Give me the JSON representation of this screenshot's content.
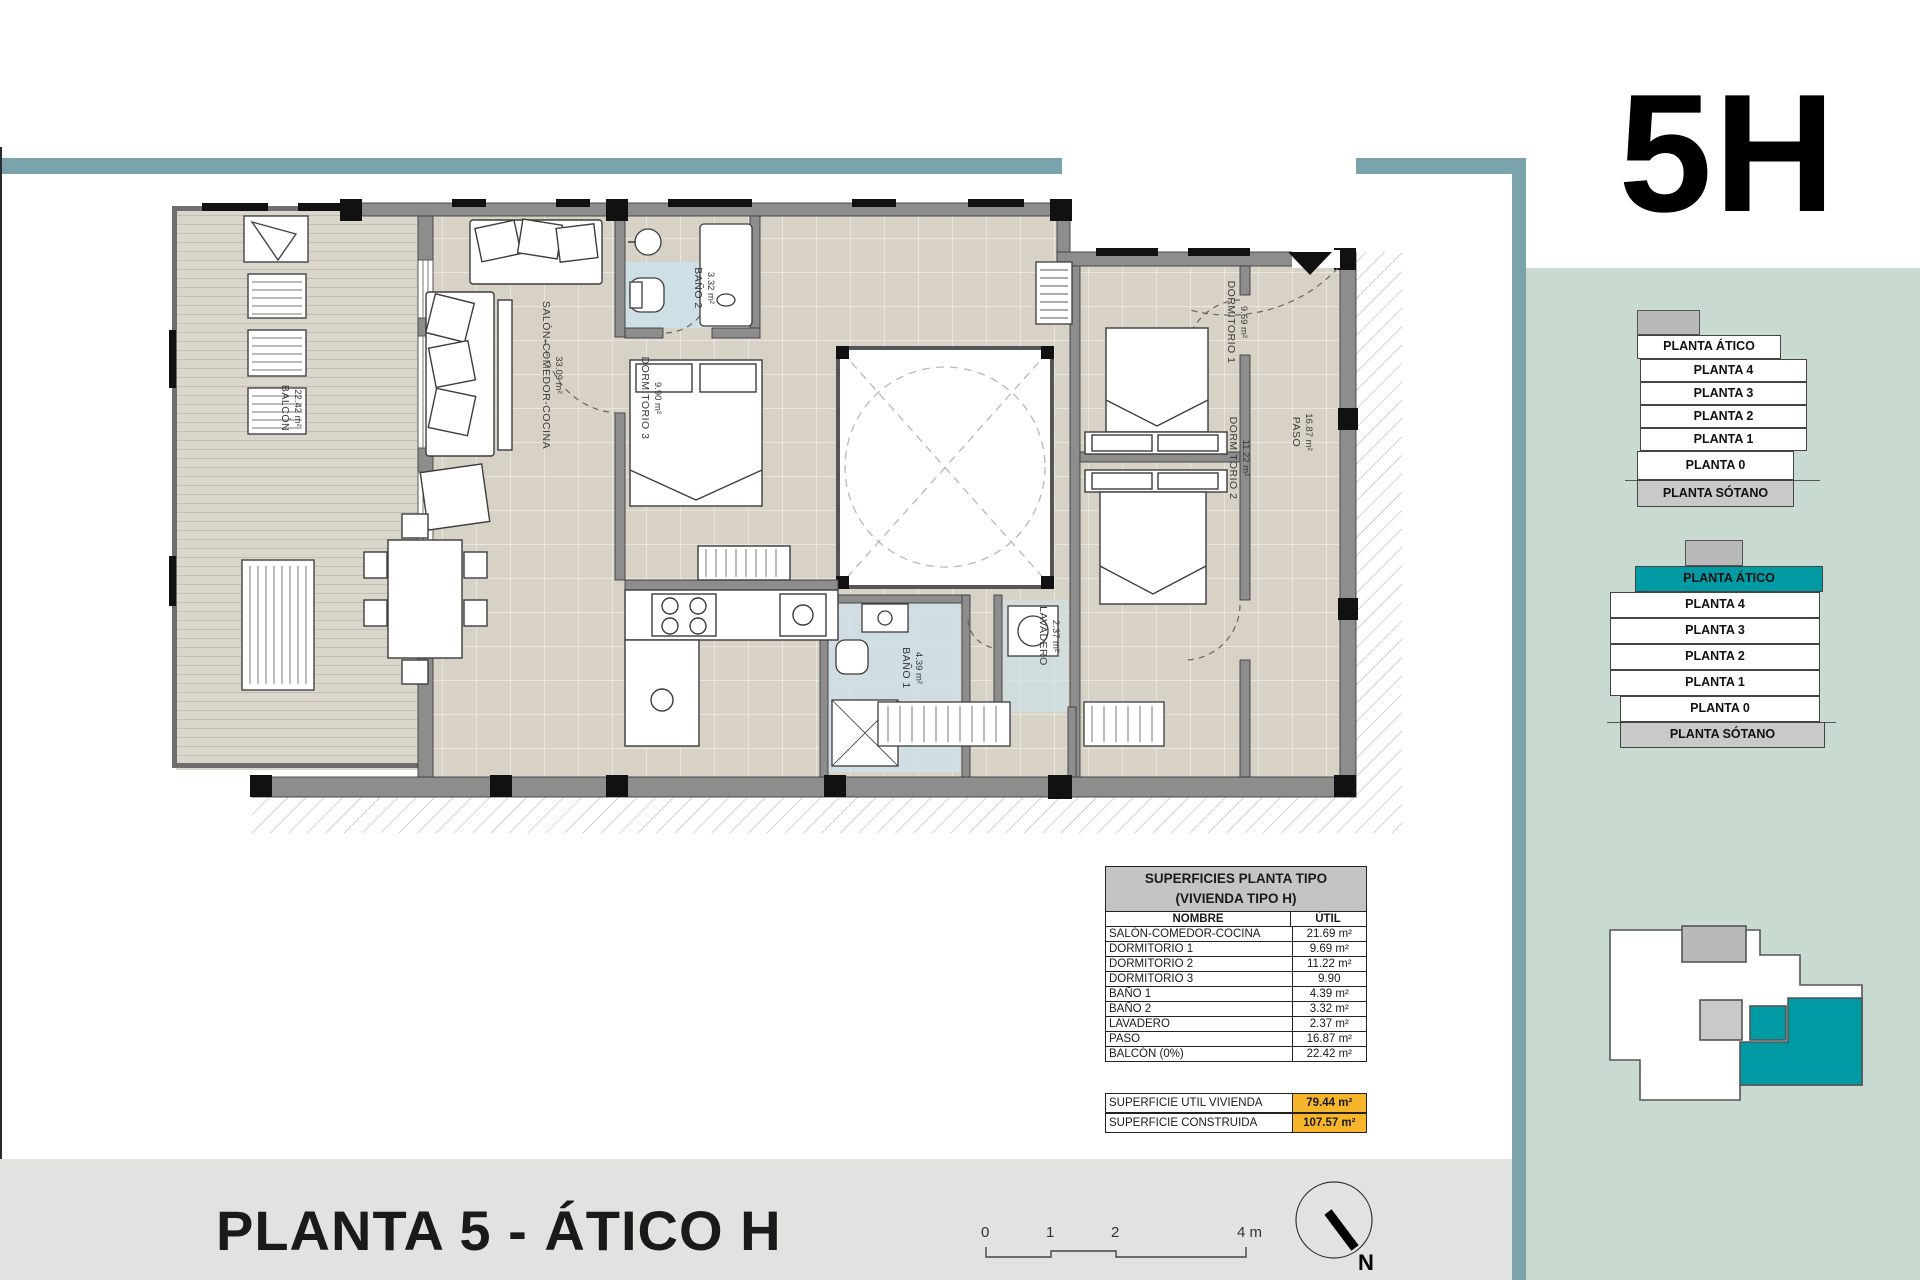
{
  "unit_label": "5H",
  "footer": {
    "title": "PLANTA 5 - ÁTICO H",
    "north_label": "N",
    "scale_labels": [
      "0",
      "1",
      "2",
      "4 m"
    ]
  },
  "surfaces_table": {
    "title_line1": "SUPERFICIES PLANTA TIPO",
    "title_line2": "(VIVIENDA TIPO H)",
    "columns": {
      "name": "NOMBRE",
      "util": "ÚTIL"
    },
    "rows": [
      {
        "name": "SALÓN-COMEDOR-COCINA",
        "util": "21.69 m²"
      },
      {
        "name": "DORMITORIO 1",
        "util": "9.69 m²"
      },
      {
        "name": "DORMITORIO 2",
        "util": "11.22 m²"
      },
      {
        "name": "DORMITORIO 3",
        "util": "9.90"
      },
      {
        "name": "BAÑO 1",
        "util": "4.39 m²"
      },
      {
        "name": "BAÑO 2",
        "util": "3.32 m²"
      },
      {
        "name": "LAVADERO",
        "util": "2.37 m²"
      },
      {
        "name": "PASO",
        "util": "16.87 m²"
      },
      {
        "name": "BALCÓN (0%)",
        "util": "22.42 m²"
      }
    ],
    "summary": [
      {
        "name": "SUPERFICIE UTIL VIVIENDA",
        "value": "79.44 m²"
      },
      {
        "name": "SUPERFICIE CONSTRUIDA",
        "value": "107.57 m²"
      }
    ]
  },
  "plan_rooms": [
    {
      "id": "salon",
      "name": "SALÓN-COMEDOR-COCINA",
      "area": "33.09 m²"
    },
    {
      "id": "bano2",
      "name": "BAÑO 2",
      "area": "3.32 m²"
    },
    {
      "id": "dorm3",
      "name": "DORMITORIO 3",
      "area": "9.90 m²"
    },
    {
      "id": "dorm1",
      "name": "DORMITORIO 1",
      "area": "9.69 m²"
    },
    {
      "id": "dorm2",
      "name": "DORMITORIO 2",
      "area": "11.22 m²"
    },
    {
      "id": "paso",
      "name": "PASO",
      "area": "16.87 m²"
    },
    {
      "id": "bano1",
      "name": "BAÑO 1",
      "area": "4.39 m²"
    },
    {
      "id": "lavadero",
      "name": "LAVADERO",
      "area": "2.37 m²"
    },
    {
      "id": "balcon",
      "name": "BALCÓN",
      "area": "22.42 m²"
    }
  ],
  "floor_stacks": {
    "levels": [
      "PLANTA ÁTICO",
      "PLANTA 4",
      "PLANTA 3",
      "PLANTA 2",
      "PLANTA 1",
      "PLANTA 0",
      "PLANTA SÓTANO"
    ],
    "highlighted_level": "PLANTA ÁTICO"
  },
  "colors": {
    "accent_teal": "#7ba3ab",
    "sidebar_green": "#c9dbd1",
    "highlight_teal": "#009aa4",
    "summary_orange": "#f6b52b",
    "sotano_gray": "#c9c9c9"
  }
}
